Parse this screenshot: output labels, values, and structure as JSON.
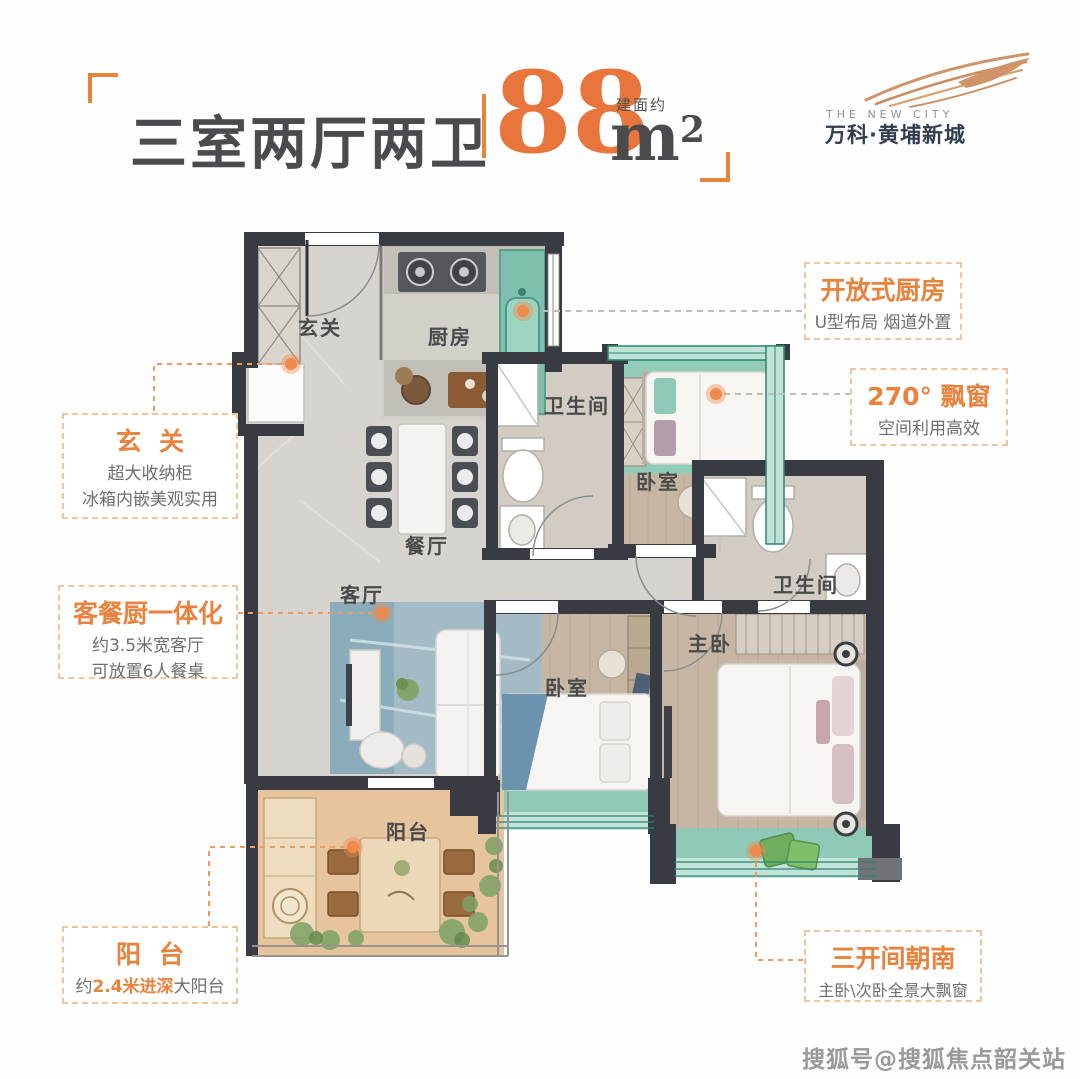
{
  "header": {
    "title": "三室两厅两卫",
    "area_value": "88",
    "area_unit": "m",
    "area_unit_sup": "2",
    "area_note": "建面约"
  },
  "logo": {
    "tagline": "THE NEW CITY",
    "brand": "万科·黄埔新城"
  },
  "plan": {
    "rooms": {
      "entry": "玄关",
      "kitchen": "厨房",
      "bath1": "卫生间",
      "bedroom1": "卧室",
      "dining": "餐厅",
      "living": "客厅",
      "bath2": "卫生间",
      "master": "主卧",
      "bedroom2": "卧室",
      "balcony": "阳台"
    }
  },
  "callouts": {
    "entry": {
      "title": "玄关",
      "line1": "超大收纳柜",
      "line2": "冰箱内嵌美观实用"
    },
    "living": {
      "title": "客餐厨一体化",
      "line1": "约3.5米宽客厅",
      "line2": "可放置6人餐桌"
    },
    "balcony": {
      "title": "阳台",
      "prefix": "约",
      "highlight": "2.4米进深",
      "suffix": "大阳台"
    },
    "kitchen": {
      "title": "开放式厨房",
      "line1": "U型布局  烟道外置"
    },
    "bay": {
      "title": "270° 飘窗",
      "line1": "空间利用高效"
    },
    "south": {
      "title": "三开间朝南",
      "line1": "主卧\\次卧全景大飘窗"
    }
  },
  "watermark": {
    "text": "搜狐号@搜狐焦点韶关站"
  },
  "colors": {
    "accent_orange": "#e8823c",
    "area_number": "#e8763c",
    "brand_navy": "#323d52",
    "wall_dark": "#383c42",
    "bay_teal": "#8fc9b7",
    "balcony_tan": "#e6c49e"
  }
}
